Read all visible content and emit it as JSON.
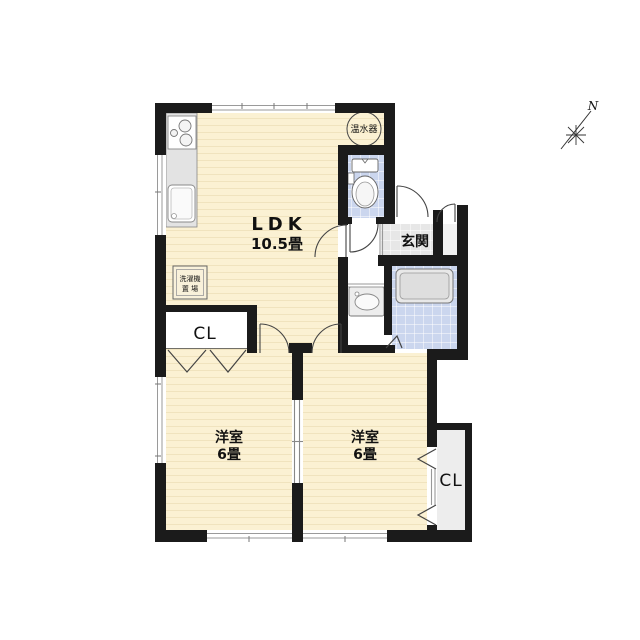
{
  "floorplan": {
    "ldk": {
      "label": "LDK",
      "size": "10.5畳"
    },
    "bedroom_left": {
      "label": "洋室",
      "size": "6畳"
    },
    "bedroom_right": {
      "label": "洋室",
      "size": "6畳"
    },
    "entrance": {
      "label": "玄関"
    },
    "closet_left": {
      "label": "CL"
    },
    "closet_right": {
      "label": "CL"
    },
    "water_heater": {
      "label": "温水器"
    },
    "laundry": {
      "line1": "洗濯機",
      "line2": "置 場"
    },
    "compass": {
      "label": "N"
    },
    "colors": {
      "wall": "#1B1B1B",
      "floor": "#FBF1D3",
      "floor_stripe": "#F0E3BE",
      "tile_blue": "#CBD6EE",
      "tile_gray": "#E7E7E7",
      "fixture_gray": "#E3E3E3",
      "line": "#666666"
    }
  }
}
